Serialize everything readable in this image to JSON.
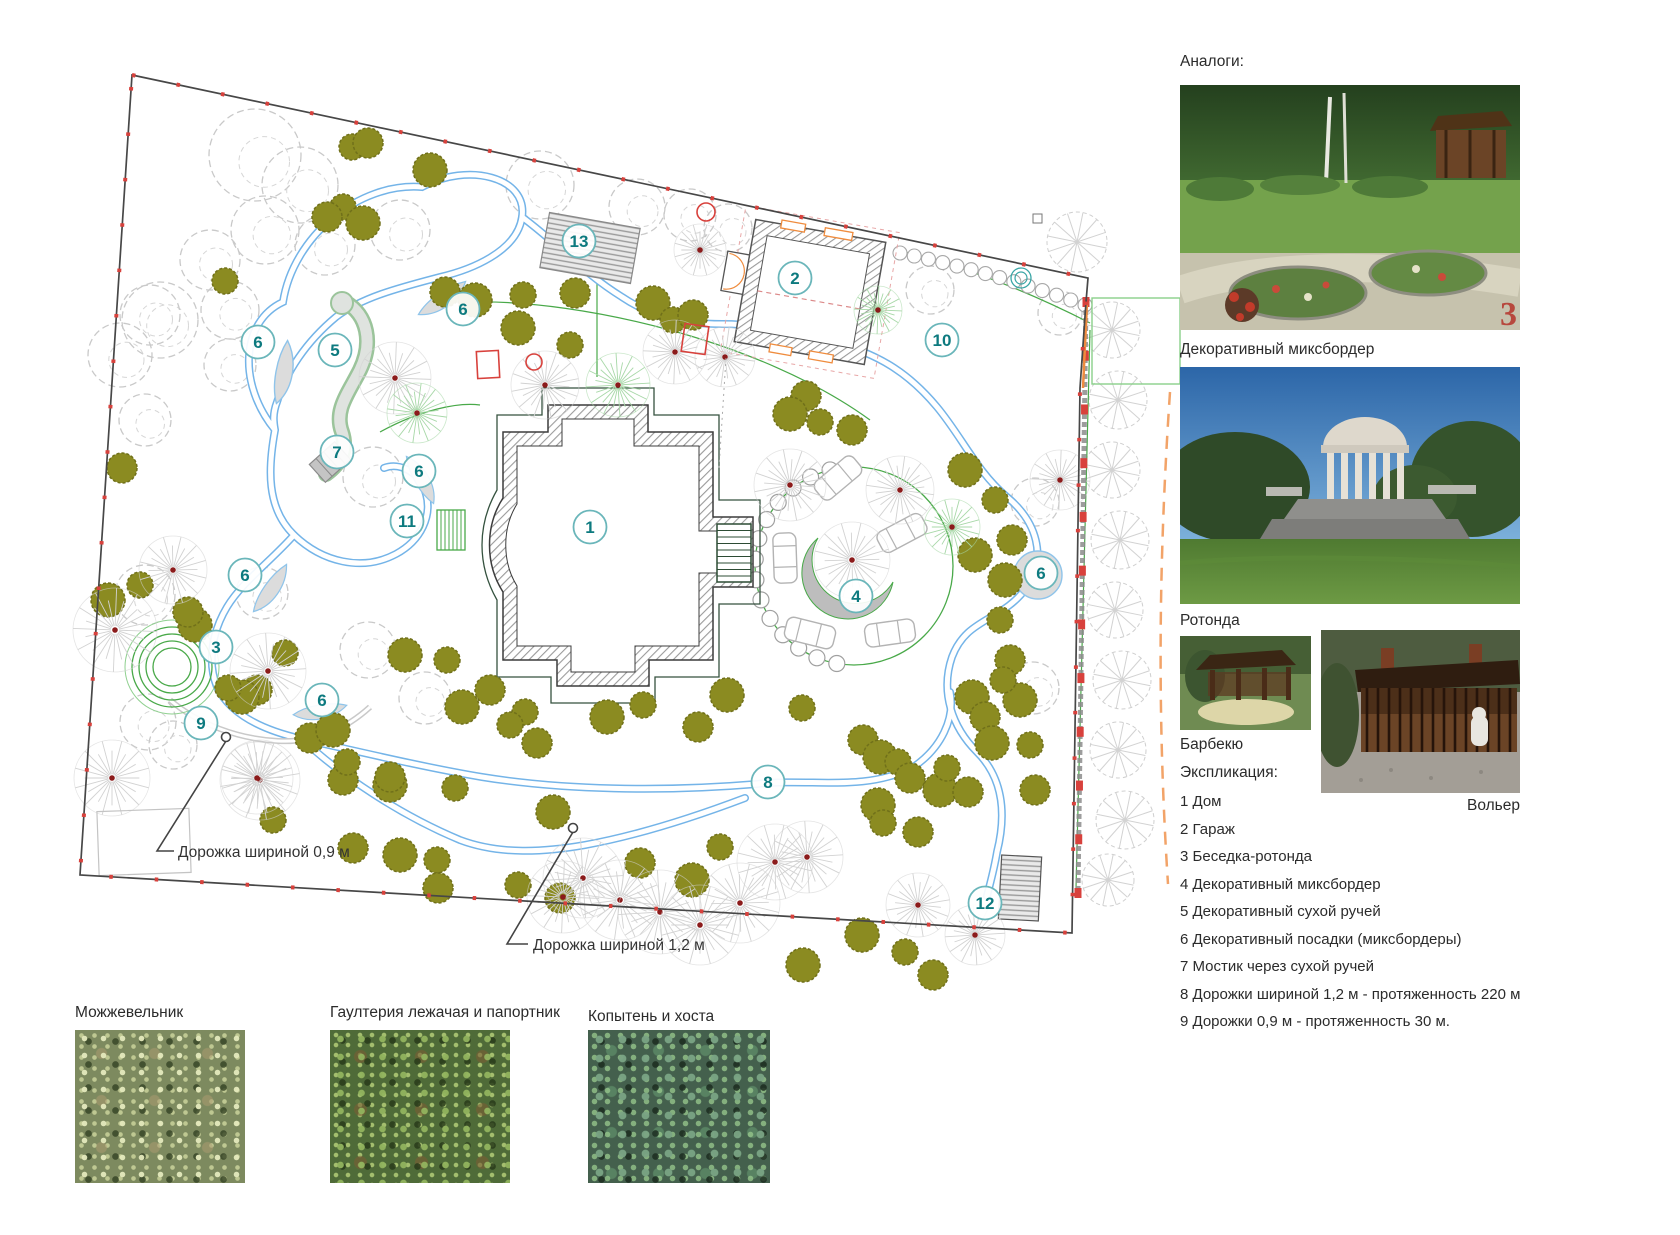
{
  "right_column": {
    "analogs_label": "Аналоги:",
    "mixborder_label": "Декоративный миксбордер",
    "rotunda_label": "Ротонда",
    "barbecue_label": "Барбекю",
    "kennel_label": "Вольер",
    "explication_title": "Экспликация:",
    "explication_items": [
      "1 Дом",
      "2 Гараж",
      "3 Беседка-ротонда",
      "4 Декоративный миксбордер",
      "5 Декоративный сухой ручей",
      "6 Декоративный посадки (миксбордеры)",
      "7 Мостик через сухой ручей",
      "8 Дорожки шириной 1,2 м - протяженность 220 м",
      "9 Дорожки 0,9 м - протяженность  30 м."
    ]
  },
  "plants": [
    {
      "label": "Можжевельник"
    },
    {
      "label": "Гаултерия лежачая и папортник"
    },
    {
      "label": "Копытень и хоста"
    }
  ],
  "plan": {
    "markers": [
      {
        "n": "1",
        "x": 590,
        "y": 527
      },
      {
        "n": "2",
        "x": 795,
        "y": 278
      },
      {
        "n": "3",
        "x": 216,
        "y": 647
      },
      {
        "n": "4",
        "x": 856,
        "y": 596
      },
      {
        "n": "5",
        "x": 335,
        "y": 350
      },
      {
        "n": "6",
        "x": 258,
        "y": 342
      },
      {
        "n": "6",
        "x": 463,
        "y": 309
      },
      {
        "n": "6",
        "x": 419,
        "y": 471
      },
      {
        "n": "6",
        "x": 245,
        "y": 575
      },
      {
        "n": "6",
        "x": 322,
        "y": 700
      },
      {
        "n": "6",
        "x": 1041,
        "y": 573
      },
      {
        "n": "7",
        "x": 337,
        "y": 452
      },
      {
        "n": "8",
        "x": 768,
        "y": 782
      },
      {
        "n": "9",
        "x": 201,
        "y": 723
      },
      {
        "n": "10",
        "x": 942,
        "y": 340
      },
      {
        "n": "11",
        "x": 407,
        "y": 521
      },
      {
        "n": "12",
        "x": 985,
        "y": 903
      },
      {
        "n": "13",
        "x": 579,
        "y": 241
      }
    ],
    "callouts": [
      {
        "text": "Дорожка шириной 0,9 м",
        "tx": 178,
        "ty": 857,
        "leader": "226,741 157,851 174,851",
        "dx": 226,
        "dy": 737
      },
      {
        "text": "Дорожка шириной 1,2 м",
        "tx": 533,
        "ty": 950,
        "leader": "573,832 507,944 528,944",
        "dx": 573,
        "dy": 828
      }
    ]
  },
  "colors": {
    "marker_number": "#0d7a7f",
    "marker_ring": "#6ab6ba",
    "path_blue": "#74b4e8",
    "tree_olive": "#8b8b21",
    "accent_green": "#49a949",
    "accent_red": "#d8413c",
    "accent_orange": "#ef8c3e"
  }
}
